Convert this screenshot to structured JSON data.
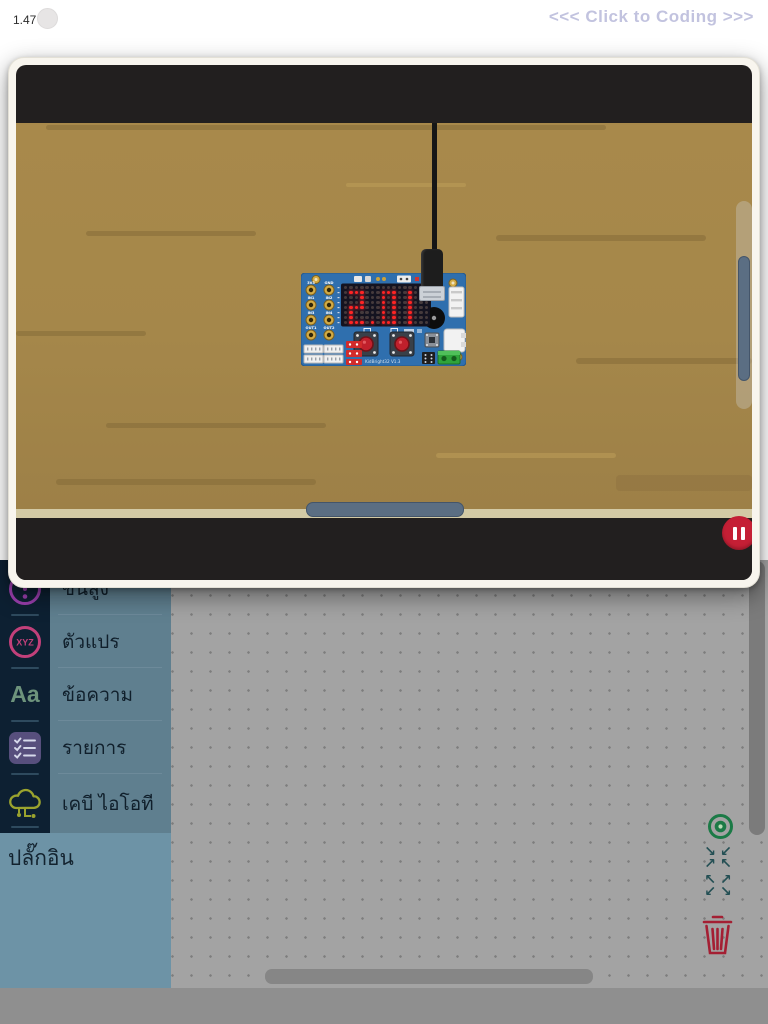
{
  "header": {
    "version": "1.47",
    "coding_link": "<<< Click to Coding >>>"
  },
  "simulator": {
    "board": {
      "name": "KidBright32 board",
      "display_text": "2.01",
      "pins": [
        "3V3",
        "GND",
        "IN1",
        "IN2",
        "IN3",
        "IN4",
        "OUT1",
        "OUT2"
      ],
      "board_label": "KidBright32 V1.3"
    },
    "pause_button": "pause-icon",
    "scene": "wooden-desk"
  },
  "sidebar": {
    "items": [
      {
        "label": "ขั้นสูง",
        "icon": "exclamation-circle-icon"
      },
      {
        "label": "ตัวแปร",
        "icon": "xyz-circle-icon"
      },
      {
        "label": "ข้อความ",
        "icon": "Aa-text-icon"
      },
      {
        "label": "รายการ",
        "icon": "checklist-icon"
      },
      {
        "label": "เคบี ไอโอที",
        "icon": "iot-cloud-icon"
      }
    ],
    "aa_icon_glyph": "Aa",
    "xyz_icon_glyph": "XYZ",
    "plugin_label": "ปลั๊กอิน"
  },
  "canvas_controls": {
    "center_icon": "target-icon",
    "zoom_out_icon": "arrows-inward-icon",
    "zoom_in_icon": "arrows-outward-icon",
    "trash_icon": "trash-icon",
    "zoom_out_rows": [
      "↘↙",
      "↗↖"
    ],
    "zoom_in_rows": [
      "↖↗",
      "↙↘"
    ]
  },
  "colors": {
    "accent_red": "#c51f35",
    "board_blue": "#2f6fae",
    "led_red": "#ff2424",
    "wood": "#a5874a",
    "sidebar_navy": "#0d2032",
    "sidebar_slate": "#5f7f8f",
    "plugin_slate": "#6d93a6",
    "canvas_gray": "#a3a3a3",
    "link_lavender": "#c2c3df",
    "trash_maroon": "#a41f33",
    "target_green": "#1b7a46"
  }
}
